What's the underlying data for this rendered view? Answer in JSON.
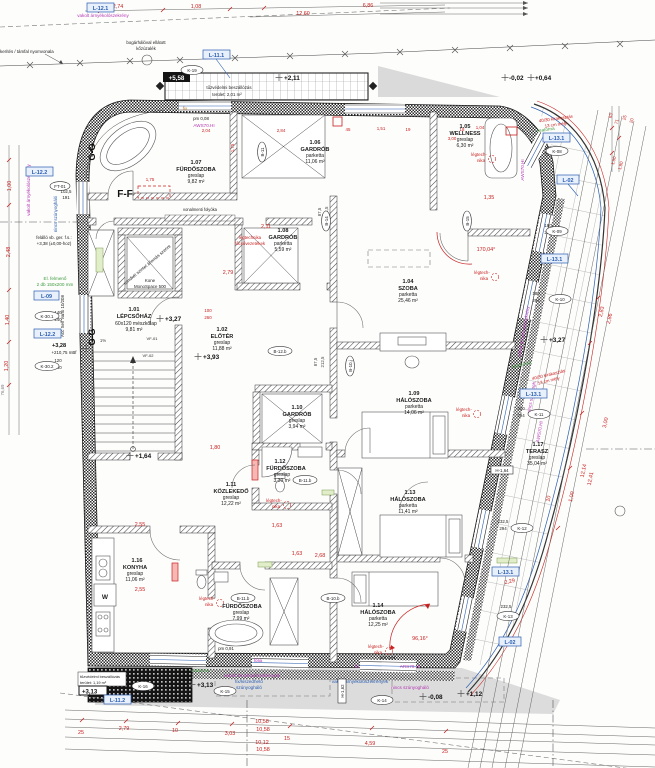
{
  "title": "emeleti alaprajz",
  "colors": {
    "dim_red": "#c8201e",
    "label_blue": "#2a5db0",
    "annot_magenta": "#b53ab5",
    "annot_green": "#3f9b3f",
    "annot_orange": "#c1762a",
    "wall_dark": "#1d1d1d",
    "gray_fill": "#dcdcdc"
  },
  "rooms": [
    {
      "n": "1.01",
      "na": "LÉPCSŐHÁZ",
      "f": "60x120 mészkőlap",
      "a": "9,81 m²"
    },
    {
      "n": "1.02",
      "na": "ELŐTÉR",
      "f": "greslap",
      "a": "11,88 m²"
    },
    {
      "n": "1.04",
      "na": "SZOBA",
      "f": "parketta",
      "a": "25,46 m²"
    },
    {
      "n": "1.05",
      "na": "WELLNESS",
      "f": "greslap",
      "a": "6,30 m²"
    },
    {
      "n": "1.06",
      "na": "GARDRÓB",
      "f": "parketta",
      "a": "11,06 m²"
    },
    {
      "n": "1.07",
      "na": "FÜRDŐSZOBA",
      "f": "greslap",
      "a": "9,82 m²"
    },
    {
      "n": "1.08",
      "na": "GARDRÓB",
      "f": "parketta",
      "a": "5,59 m²"
    },
    {
      "n": "1.09",
      "na": "HÁLÓSZOBA",
      "f": "parketta",
      "a": "14,06 m²"
    },
    {
      "n": "1.10",
      "na": "GARDRÓB",
      "f": "greslap",
      "a": "3,94 m²"
    },
    {
      "n": "1.11",
      "na": "KÖZLEKEDŐ",
      "f": "greslap",
      "a": "12,22 m²"
    },
    {
      "n": "1.12",
      "na": "FÜRDŐSZOBA",
      "f": "greslap",
      "a": "3,30 m²"
    },
    {
      "n": "1.13",
      "na": "HÁLÓSZOBA",
      "f": "parketta",
      "a": "11,41 m²"
    },
    {
      "n": "1.14",
      "na": "HÁLÓSZOBA",
      "f": "parketta",
      "a": "12,25 m²"
    },
    {
      "n": "1.15",
      "na": "FÜRDŐSZOBA",
      "f": "greslap",
      "a": "7,99 m²"
    },
    {
      "n": "1.16",
      "na": "KONYHA",
      "f": "greslap",
      "a": "11,06 m²"
    },
    {
      "n": "1.17",
      "na": "TERASZ",
      "f": "greslap",
      "a": "35,04 m²"
    }
  ],
  "levels": {
    "t0": "+2,11",
    "t1": "-0,02",
    "t2": "+0,64",
    "t3": "+5,58",
    "m0": "+3,27",
    "m1": "+3,93",
    "m2": "+1,64",
    "m3": "+3,13",
    "m4": "+3,13",
    "m5": "+3,27",
    "m6": "+3,28",
    "m7": "+210,75 mBf",
    "b0": "-0,08",
    "b1": "+1,12"
  },
  "dims": {
    "top": [
      "2,74",
      "1,08",
      "12,60",
      "6,86"
    ],
    "win": [
      "2,04",
      "2,84",
      "1,51",
      "45",
      "19",
      "18",
      "3,00",
      "1,04",
      "1,75",
      "1,75"
    ],
    "mid": [
      "2,11",
      "1,35",
      "170,04°",
      "2,55",
      "1,80",
      "1,63",
      "2,68",
      "2,55",
      "1,63",
      "96,16°",
      "2,79",
      "100",
      "260",
      "87,5",
      "212,5",
      "87,5",
      "212,5",
      "1%"
    ],
    "rw": [
      "150",
      "294",
      "180",
      "294",
      "180",
      "294",
      "210",
      "294",
      "232,5",
      "294",
      "232,5",
      "294"
    ],
    "left": [
      "1,00",
      "2,48",
      "1,40",
      "1,20",
      "76,69",
      "102,5",
      "191",
      "140",
      "240",
      "120",
      "240"
    ],
    "right": [
      "63",
      "71",
      "25",
      "20",
      "1,50",
      "1,80",
      "2,83",
      "2,86",
      "3,00",
      "12,14",
      "12,41",
      "1,00",
      "10",
      "2,29"
    ],
    "bottom": [
      "25",
      "2,79",
      "10",
      "3,03",
      "15",
      "4,59",
      "25"
    ],
    "bt": [
      "10,58",
      "10,58",
      "10,12",
      "10,58"
    ]
  },
  "notes": {
    "fence": "kerítés / támfal nyomvonala",
    "gravel1": "bogárhálóval ellátott",
    "gravel2": "kőzúzalék",
    "fire1a": "tűzvédelmi beszállózás",
    "fire1b": "terület: 2,01 m²",
    "fire2a": "tűzvédelmi beszállózás",
    "fire2b": "terület: 1,19 m²",
    "rc1": "felálló vb. ger. f.s.:",
    "rc2": "+3,38 (±0,00-hoz)",
    "el1": "El. felmenő",
    "el2": "2 db 150x200 mm",
    "acc": "Acc Self Vario 10/208",
    "lift1": "Kone",
    "lift2": "MonoSpace 500",
    "lift3": "mindkét szintet állomás szerint",
    "drain": "vonalmenti folyóka",
    "lt1": "légtech-",
    "lt2": "nika",
    "ltm1": "légtechnika",
    "ltm2": "főcsővezetékek",
    "sh1": "vakolt árnyékolószekrények",
    "sh2": "fix/kiszedhető",
    "sh3": "szúnyogháló",
    "shv": "vakolt árnyékolószekrény",
    "nofly": "nincs szúnyogh.",
    "nofly2": "nincs szúnyogháló",
    "kir1": "40/30 kirakasztás",
    "kir2": "13 cm mély",
    "cs1": "csatorna",
    "cs2": "csatorna2",
    "pm91": "pm 0,91",
    "pm08": "pm 0,08",
    "aws": "AWS70.HI",
    "ars": "ARS70.HI",
    "fix": "fix",
    "folia": "fólia",
    "vf01": "VF-01",
    "vf02": "VF-02",
    "w": "W"
  },
  "markers": {
    "ft01": "FT-01",
    "k19": "K-19",
    "k16": "K-16",
    "k15": "K-15",
    "k14": "K-14",
    "k13": "K-13",
    "k12": "K-12",
    "k11": "K-11",
    "k10": "K-10",
    "k09": "K-09",
    "k08": "K-08",
    "k301": "K-30.1",
    "k302": "K-30.2",
    "b11": "B-11",
    "b14": "B-14",
    "b15": "B-15",
    "b12b": "B-12.b",
    "b10j": "B-10.j",
    "b11b": "B-11.b",
    "b10b": "B-10.b",
    "h162": "H-1,62",
    "h164": "H-1,64"
  },
  "blue": {
    "l111": "L-11.1",
    "l112": "L-11.2",
    "l121": "L-12.1",
    "l122": "L-12.2",
    "l09": "L-09",
    "l131": "L-13.1",
    "l02": "L-02"
  },
  "sections": {
    "ff": "F-F",
    "gg": "G-G"
  }
}
